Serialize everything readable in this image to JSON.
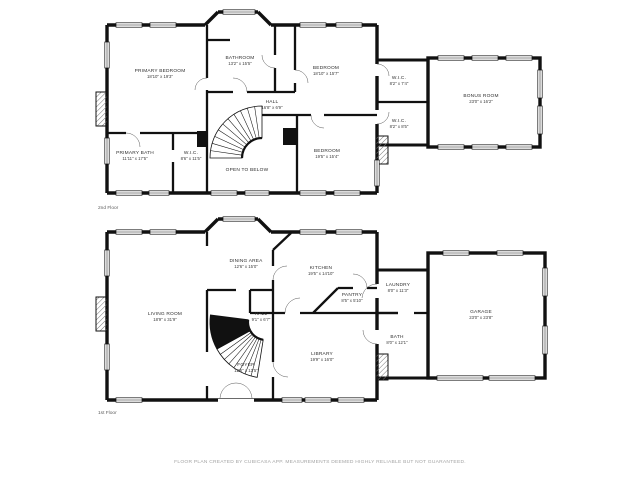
{
  "footer": {
    "text": "FLOOR PLAN CREATED BY CUBICASA APP. MEASUREMENTS DEEMED HIGHLY RELIABLE BUT NOT GUARANTEED."
  },
  "floors": [
    {
      "caption": "2nd Floor",
      "rooms": [
        {
          "name": "PRIMARY BEDROOM",
          "dims": "18'10\" x 19'3\"",
          "x": 160,
          "y": 72
        },
        {
          "name": "BATHROOM",
          "dims": "13'2\" x 15'5\"",
          "x": 240,
          "y": 59
        },
        {
          "name": "BEDROOM",
          "dims": "18'10\" x 15'7\"",
          "x": 326,
          "y": 69
        },
        {
          "name": "W.I.C.",
          "dims": "8'2\" x 7'4\"",
          "x": 399,
          "y": 79
        },
        {
          "name": "W.I.C.",
          "dims": "8'2\" x 8'5\"",
          "x": 399,
          "y": 122
        },
        {
          "name": "BONUS ROOM",
          "dims": "23'0\" x 16'2\"",
          "x": 481,
          "y": 97
        },
        {
          "name": "HALL",
          "dims": "16'8\" x 6'9\"",
          "x": 272,
          "y": 103
        },
        {
          "name": "PRIMARY BATH",
          "dims": "11'11\" x 17'5\"",
          "x": 135,
          "y": 154
        },
        {
          "name": "W.I.C.",
          "dims": "8'6\" x 11'5\"",
          "x": 191,
          "y": 154
        },
        {
          "name": "OPEN TO BELOW",
          "dims": "",
          "x": 247,
          "y": 171
        },
        {
          "name": "BEDROOM",
          "dims": "19'5\" x 15'4\"",
          "x": 327,
          "y": 152
        }
      ]
    },
    {
      "caption": "1st Floor",
      "rooms": [
        {
          "name": "DINING AREA",
          "dims": "12'6\" x 15'0\"",
          "x": 246,
          "y": 262
        },
        {
          "name": "KITCHEN",
          "dims": "19'5\" x 14'10\"",
          "x": 321,
          "y": 269
        },
        {
          "name": "PANTRY",
          "dims": "8'5\" x 5'10\"",
          "x": 352,
          "y": 296
        },
        {
          "name": "LAUNDRY",
          "dims": "8'0\" x 11'3\"",
          "x": 398,
          "y": 286
        },
        {
          "name": "LIVING ROOM",
          "dims": "18'9\" x 31'9\"",
          "x": 165,
          "y": 315
        },
        {
          "name": "HALL",
          "dims": "9'1\" x 6'7\"",
          "x": 261,
          "y": 315
        },
        {
          "name": "GARAGE",
          "dims": "23'0\" x 23'8\"",
          "x": 481,
          "y": 313
        },
        {
          "name": "FOYER",
          "dims": "12'6\" x 12'5\"",
          "x": 246,
          "y": 366
        },
        {
          "name": "LIBRARY",
          "dims": "19'9\" x 16'0\"",
          "x": 322,
          "y": 355
        },
        {
          "name": "BATH",
          "dims": "8'0\" x 12'1\"",
          "x": 397,
          "y": 338
        }
      ]
    }
  ]
}
